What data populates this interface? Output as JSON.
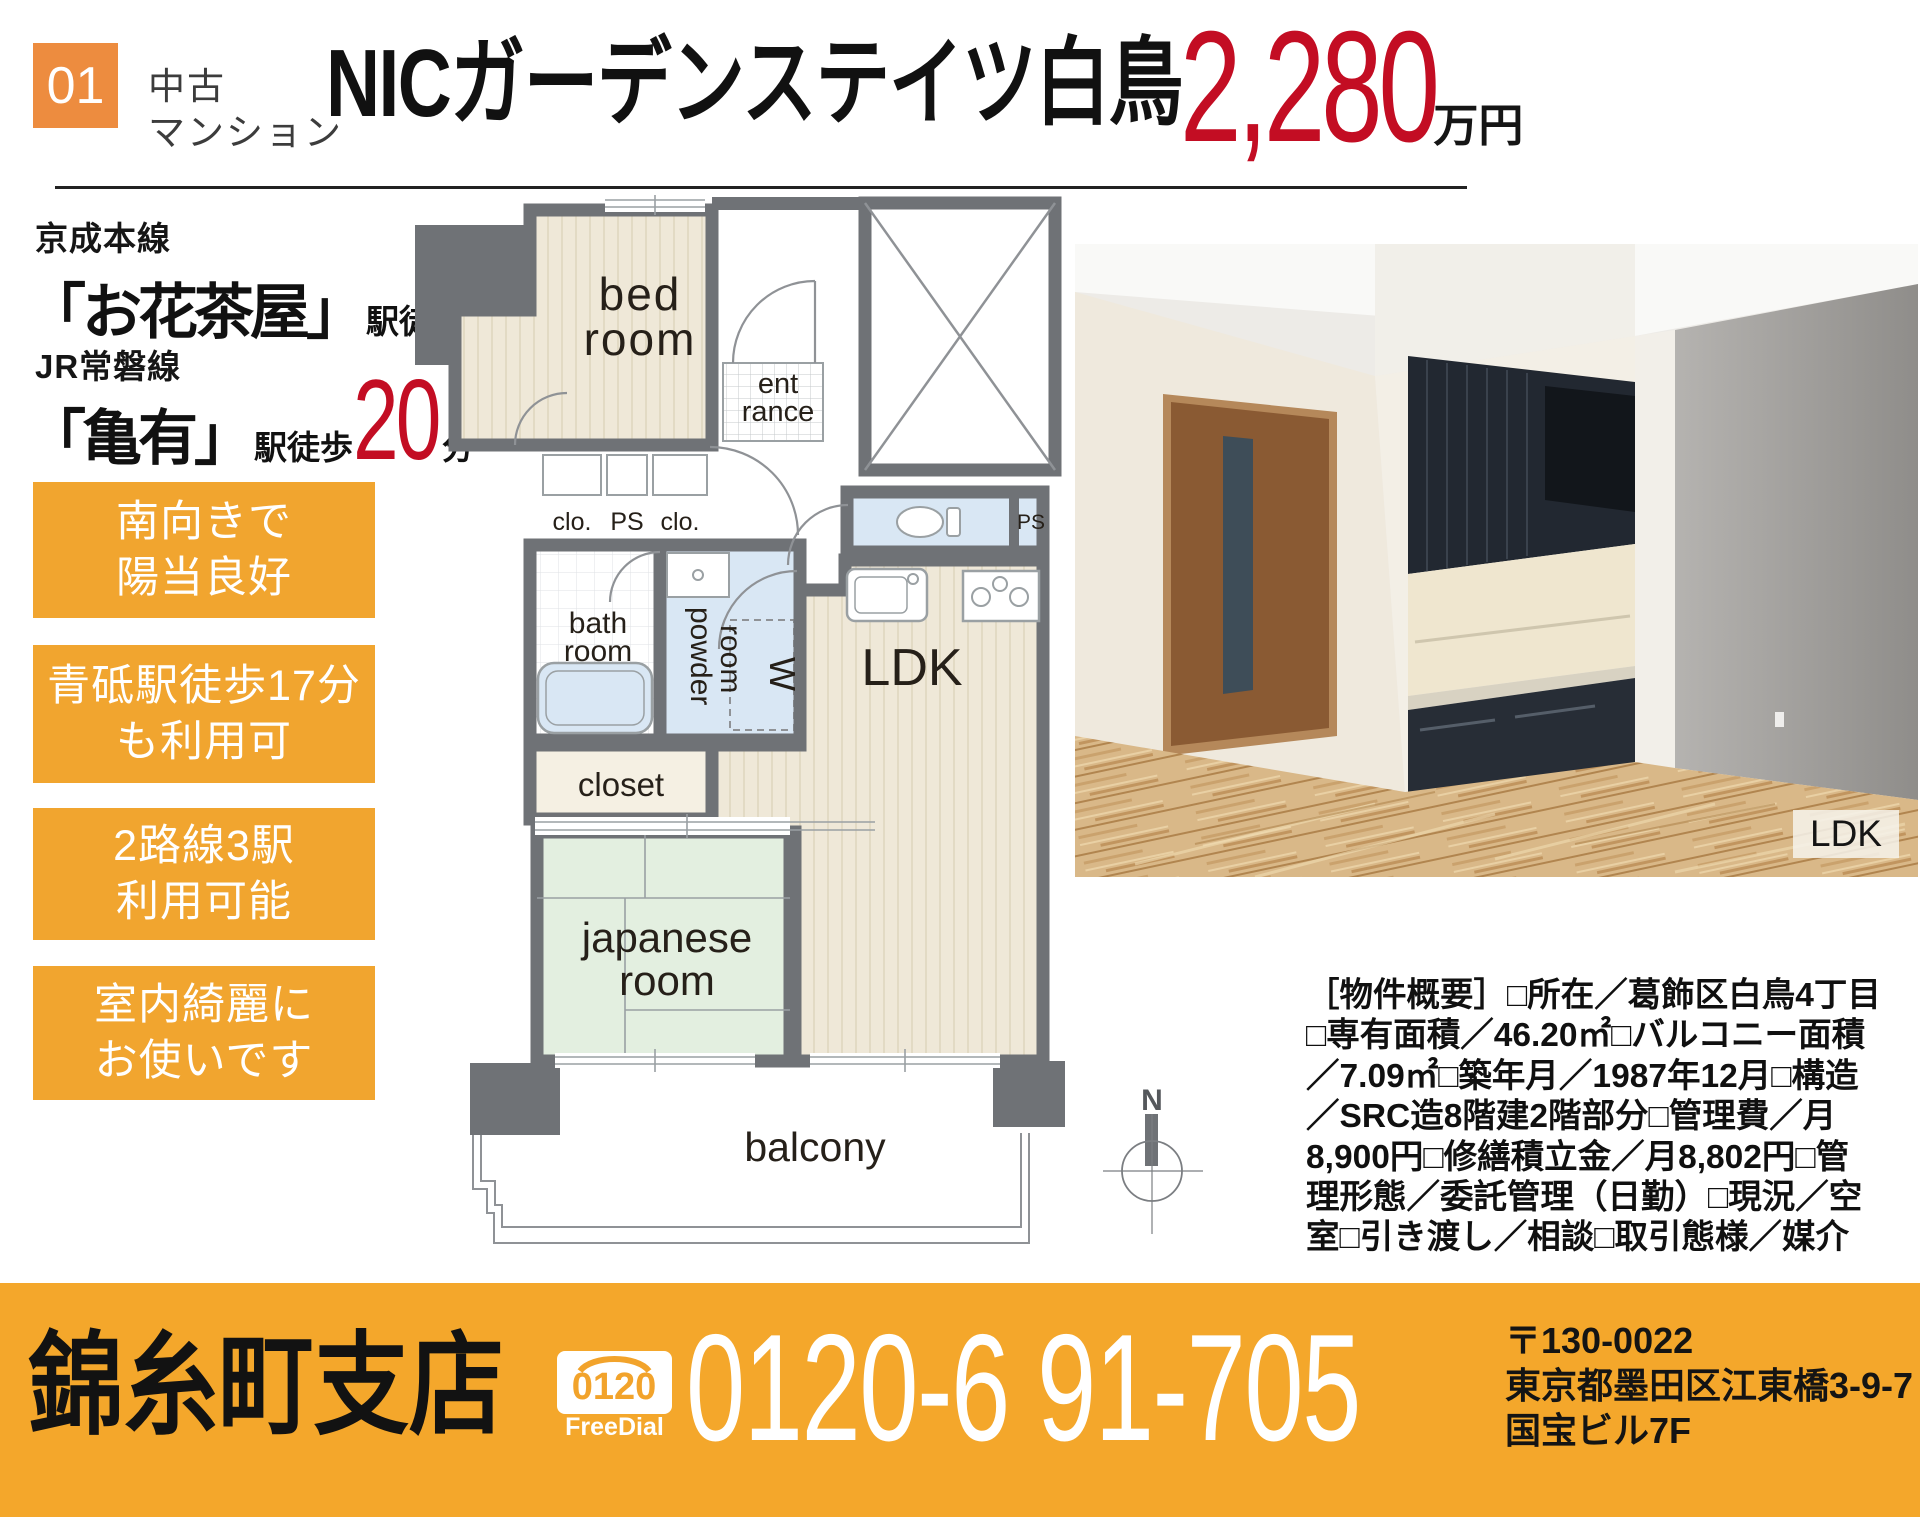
{
  "header": {
    "badge": "01",
    "category": [
      "中古",
      "マンション"
    ],
    "title": "NICガーデンステイツ白鳥",
    "price": "2,280",
    "price_unit": "万円"
  },
  "access": [
    {
      "line": "京成本線",
      "station": "「お花茶屋」",
      "walk": "駅徒歩",
      "minutes": "13",
      "minutes_unit": "分"
    },
    {
      "line": "JR常磐線",
      "station": "「亀有」",
      "walk": "駅徒歩",
      "minutes": "20",
      "minutes_unit": "分"
    }
  ],
  "features": [
    {
      "line1": "南向きで",
      "line2": "陽当良好"
    },
    {
      "line1": "青砥駅徒歩17分",
      "line2": "も利用可"
    },
    {
      "line1": "2路線3駅",
      "line2": "利用可能"
    },
    {
      "line1": "室内綺麗に",
      "line2": "お使いです"
    }
  ],
  "floorplan": {
    "bedroom": [
      "bed",
      "room"
    ],
    "entrance": [
      "ent",
      "rance"
    ],
    "closet_abbr_left": "clo.",
    "ps_upper": "PS",
    "closet_abbr_right": "clo.",
    "bathroom": [
      "bath",
      "room"
    ],
    "powder_room": [
      "powder",
      "room"
    ],
    "washer": "W",
    "ps_toilet": "PS",
    "closet": "closet",
    "japanese_room": [
      "japanese",
      "room"
    ],
    "ldk": "LDK",
    "balcony": "balcony",
    "compass": "N"
  },
  "photo": {
    "caption": "LDK"
  },
  "overview": {
    "lines": [
      "［物件概要］□所在／葛飾区白鳥4丁目",
      "□専有面積／46.20㎡□バルコニー面積",
      "／7.09㎡□築年月／1987年12月□構造",
      "／SRC造8階建2階部分□管理費／月",
      "8,900円□修繕積立金／月8,802円□管",
      "理形態／委託管理（日勤）□現況／空",
      "室□引き渡し／相談□取引態様／媒介"
    ]
  },
  "footer": {
    "branch": "錦糸町支店",
    "freedial_number": "0120",
    "freedial_label": "FreeDial",
    "phone": "0120-6 91-705",
    "postal_code": "〒130-0022",
    "address_line": "東京都墨田区江東橋3-9-7",
    "building": "国宝ビル7F"
  },
  "colors": {
    "accent_orange": "#F1A52F",
    "badge_orange": "#ED8C3F",
    "footer_orange": "#F4A72B",
    "price_red": "#C30D23",
    "wall_gray": "#6F7276",
    "room_beige": "#EFE8D8",
    "tatami_green": "#E3EFE0",
    "wet_blue": "#D9E7F4"
  }
}
